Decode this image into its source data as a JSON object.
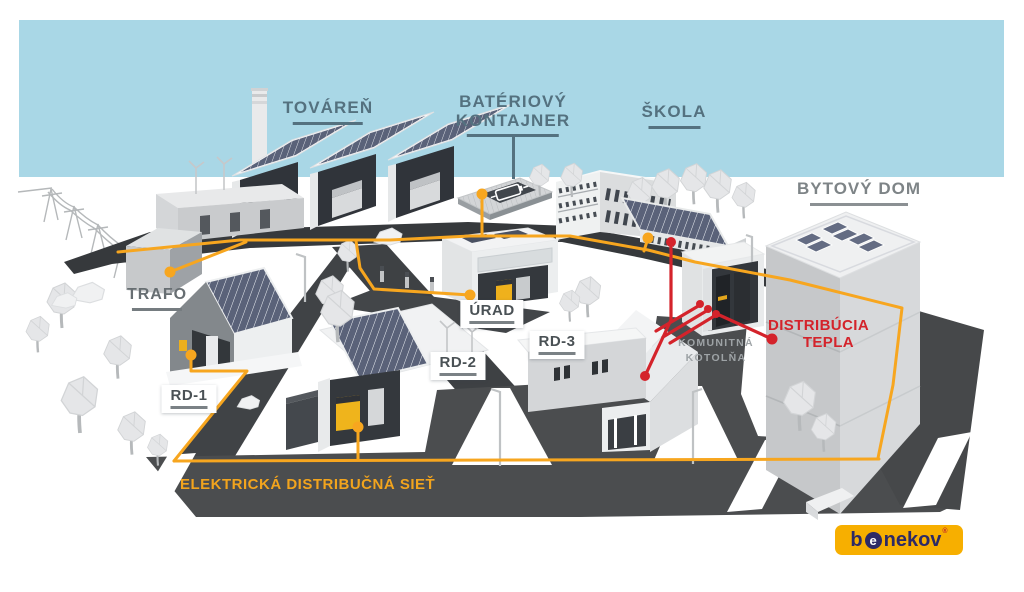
{
  "diagram": {
    "labels": {
      "factory": "TOVÁREŇ",
      "battery_line1": "BATÉRIOVÝ",
      "battery_line2": "KONTAJNER",
      "school": "ŠKOLA",
      "apartment": "BYTOVÝ DOM",
      "transformer": "TRAFO",
      "office": "ÚRAD",
      "house1": "RD-1",
      "house2": "RD-2",
      "house3": "RD-3",
      "boiler_line1": "KOMUNITNÁ",
      "boiler_line2": "KOTOLŇA",
      "heat_line1": "DISTRIBÚCIA",
      "heat_line2": "TEPLA",
      "electric_grid": "ELEKTRICKÁ DISTRIBUČNÁ SIEŤ"
    },
    "logo": {
      "prefix": "b",
      "circle_letter": "e",
      "suffix": "nekov",
      "registered_mark": "®"
    },
    "colors": {
      "sky": "#A9D7E6",
      "electric_line": "#F7A61F",
      "heat_line": "#D4232B",
      "label_slate": "#54717F",
      "label_gray": "#7E8487",
      "plate_text": "#4A5155",
      "boiler_label": "#9EA3A6",
      "grid_label": "#F2A41D",
      "logo_bg": "#F7AF00",
      "logo_text": "#2D2A66",
      "road": "#4A4C4E"
    }
  }
}
